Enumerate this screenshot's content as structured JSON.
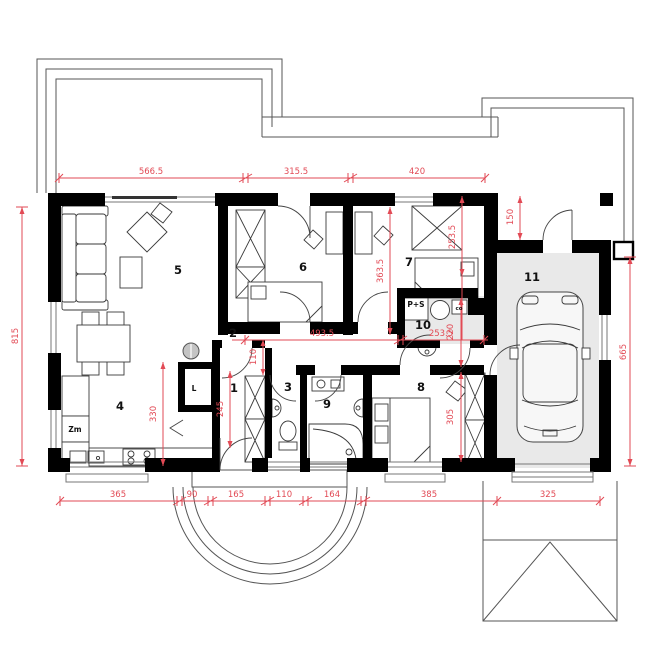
{
  "plan": {
    "rooms": {
      "r1": "1",
      "r2": "2",
      "r3": "3",
      "r4": "4",
      "r5": "5",
      "r6": "6",
      "r7": "7",
      "r8": "8",
      "r9": "9",
      "r10": "10",
      "r11": "11"
    },
    "fixtures": {
      "fridge": "L",
      "dishwasher": "Zm",
      "washer_dryer": "P+S",
      "boiler": "co"
    },
    "dims": {
      "top": [
        "566.5",
        "315.5",
        "420"
      ],
      "bottom": [
        "365",
        "90",
        "165",
        "110",
        "164",
        "385",
        "325"
      ],
      "left": "815",
      "right": "665",
      "corridor": [
        "493.5",
        "253.5"
      ],
      "garage_front": "150",
      "room7_a": "363.5",
      "room7_b": "253.5",
      "hall_a": "110",
      "hall_b": "245",
      "kitchen": "330",
      "room10": "220",
      "room8": "305"
    },
    "colors": {
      "dimension": "#e24a55",
      "wall": "#000000",
      "garage_floor": "#e9e9e9",
      "column": "#c4c4c4"
    }
  }
}
